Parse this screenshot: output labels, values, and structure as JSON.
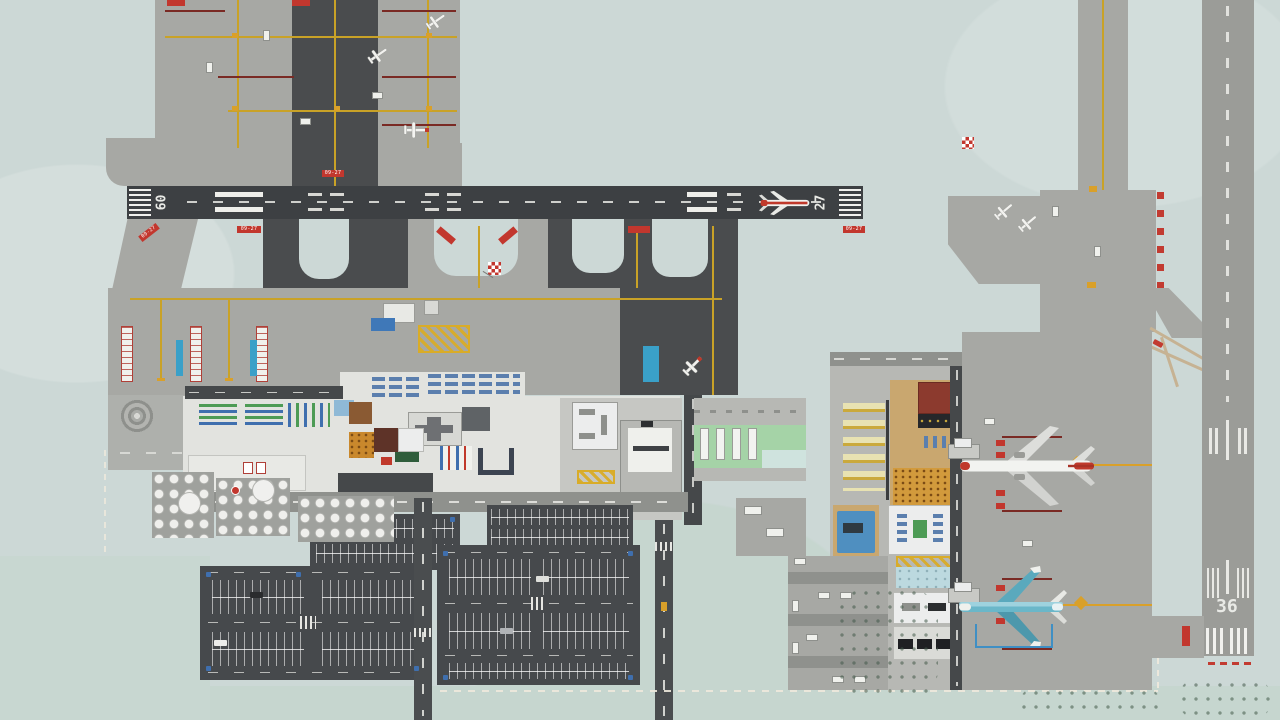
{
  "game": {
    "title": "Airport management simulation - top-down airport overview"
  },
  "runways": {
    "main": {
      "left_number": "09",
      "right_number": "27",
      "surface": "dark asphalt"
    },
    "cross": {
      "number": "36",
      "surface": "light concrete"
    }
  },
  "signs": {
    "runway_label": "09-27"
  },
  "aircraft": [
    {
      "name": "airliner-on-runway",
      "livery": "white with red stripe",
      "location": "runway 09/27 near threshold 27"
    },
    {
      "name": "airliner-red-tail",
      "livery": "white with red nose and tail",
      "location": "north gate stand, east apron"
    },
    {
      "name": "airliner-teal",
      "livery": "teal blue",
      "location": "south gate stand, east apron"
    },
    {
      "name": "ga-plane-white",
      "livery": "white",
      "location": "general aviation apron"
    }
  ],
  "palette": {
    "background": "#ccd8d6",
    "runway_asphalt": "#3d4043",
    "runway_concrete": "#9b9c98",
    "apron_concrete": "#a7a8a4",
    "asphalt_dark": "#45484b",
    "service_road": "#8f918d",
    "taxi_line_yellow": "#c9a227",
    "stand_line_darkred": "#7a2a24",
    "sign_red": "#c2372e",
    "marking_white": "#efefec",
    "terminal_floor": "#e2e3df",
    "terminal_tan": "#c9a76f",
    "hall_green": "#a5d3a7",
    "seat_blue": "#5b7fae",
    "desk_green": "#4d9b55",
    "jet_bridge_blue": "#3aa0c8",
    "plane_accent_red": "#c0392b",
    "plane_teal": "#62b3c6"
  }
}
